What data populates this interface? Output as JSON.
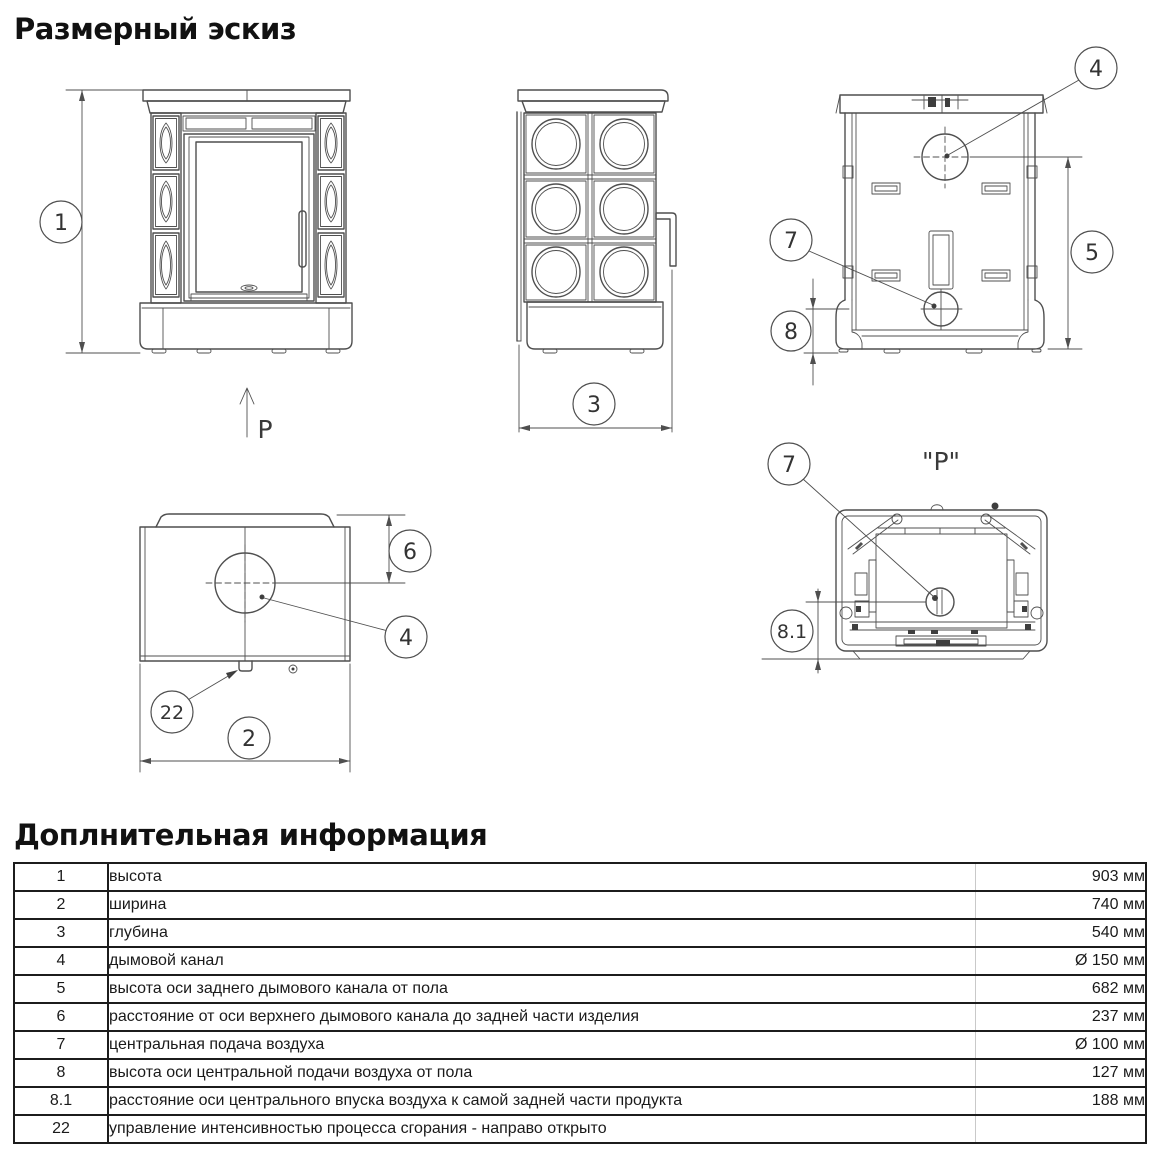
{
  "sketch": {
    "title": "Размерный эскиз",
    "p_direction_label": "P",
    "p_view_label": "\"P\"",
    "callouts": {
      "height": "1",
      "width": "2",
      "depth": "3",
      "flue": "4",
      "flue_axis_height": "5",
      "flue_axis_offset": "6",
      "air_inlet": "7",
      "air_axis_height": "8",
      "air_axis_offset": "8.1",
      "combustion_control": "22"
    }
  },
  "info": {
    "title": "Доплнительная информация",
    "rows": [
      {
        "num": "1",
        "desc": "высота",
        "value": "903 мм"
      },
      {
        "num": "2",
        "desc": "ширина",
        "value": "740 мм"
      },
      {
        "num": "3",
        "desc": "глубина",
        "value": "540 мм"
      },
      {
        "num": "4",
        "desc": "дымовой канал",
        "value": "Ø 150 мм"
      },
      {
        "num": "5",
        "desc": "высота оси заднего дымового канала от пола",
        "value": "682 мм"
      },
      {
        "num": "6",
        "desc": "расстояние от оси верхнего дымового канала до задней части изделия",
        "value": "237 мм"
      },
      {
        "num": "7",
        "desc": "центральная подача воздуха",
        "value": "Ø 100 мм"
      },
      {
        "num": "8",
        "desc": "высота оси центральной подачи воздуха от пола",
        "value": "127 мм"
      },
      {
        "num": "8.1",
        "desc": "расстояние оси центрального впуска воздуха к самой задней части продукта",
        "value": "188 мм"
      },
      {
        "num": "22",
        "desc": "управление интенсивностью процесса сгорания - направо открыто",
        "value": ""
      }
    ]
  }
}
